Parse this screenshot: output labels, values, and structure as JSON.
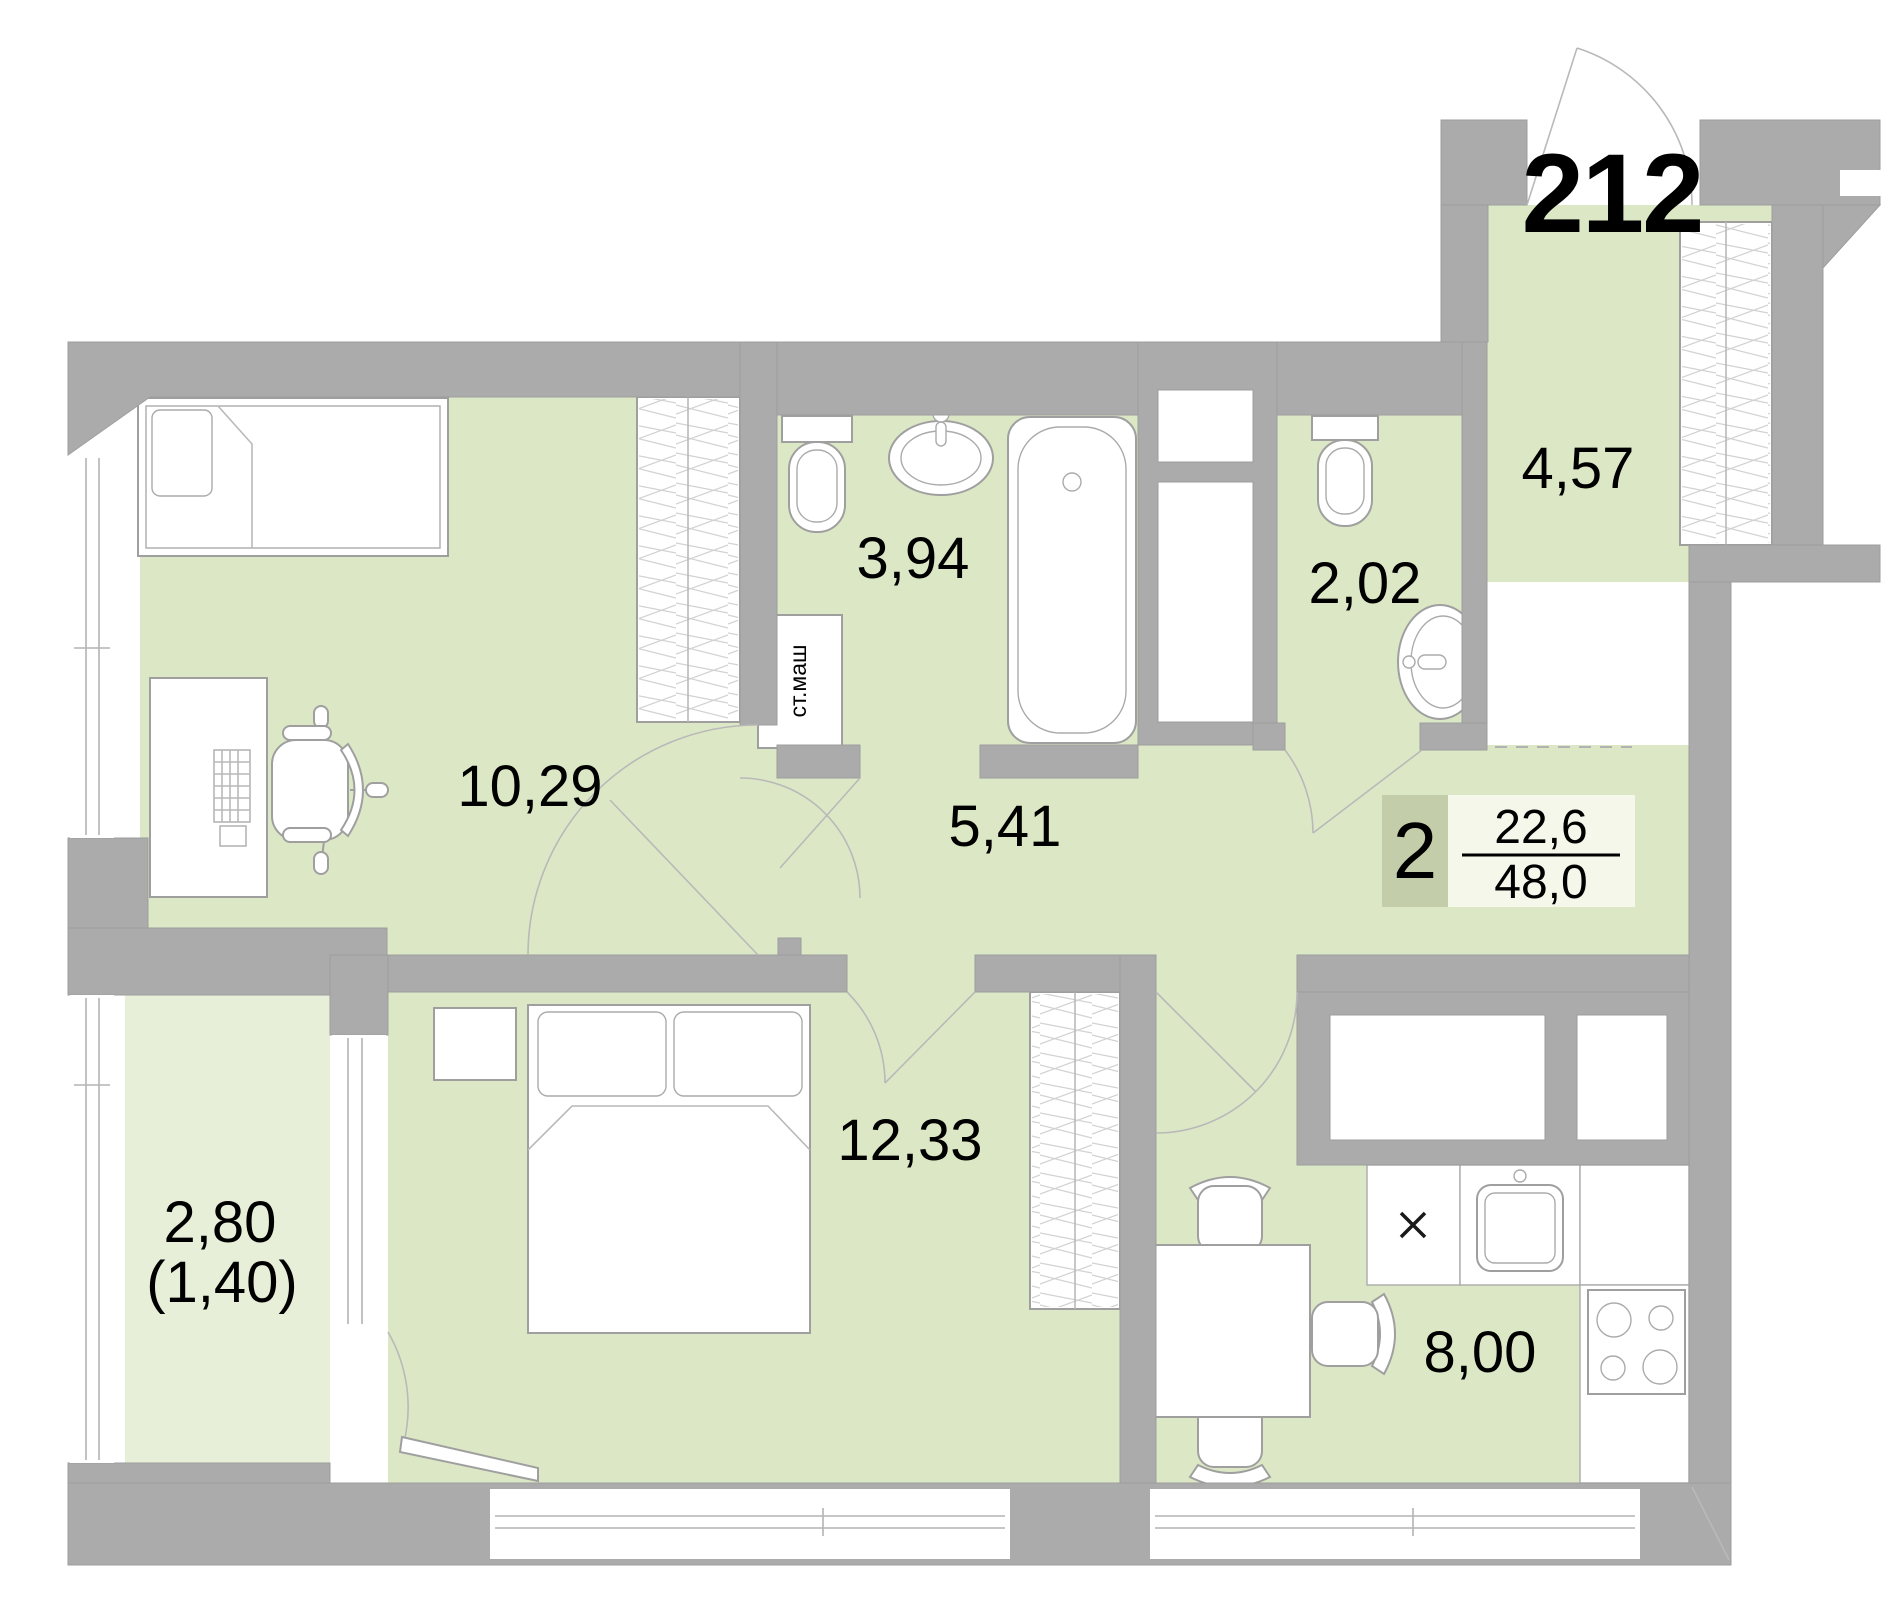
{
  "plan": {
    "unit_number": "212",
    "summary_badge": {
      "rooms_count": "2",
      "living_area": "22,6",
      "total_area": "48,0"
    },
    "rooms": {
      "entry_hall": {
        "area": "4,57"
      },
      "bathroom": {
        "area": "3,94"
      },
      "wc": {
        "area": "2,02"
      },
      "living_room": {
        "area": "10,29"
      },
      "hallway": {
        "area": "5,41"
      },
      "bedroom": {
        "area": "12,33"
      },
      "balcony": {
        "area": "2,80",
        "area_coefficient": "(1,40)"
      },
      "kitchen": {
        "area": "8,00"
      }
    },
    "appliance_labels": {
      "washing_machine": "ст.маш"
    },
    "colors": {
      "floor_green": "#dce8c5",
      "balcony_green": "#e7efd8",
      "wall_gray": "#ababab",
      "badge_count_bg": "#c3cda9",
      "badge_area_bg": "#f4f7ea",
      "outline_gray": "#9f9f9f"
    }
  }
}
